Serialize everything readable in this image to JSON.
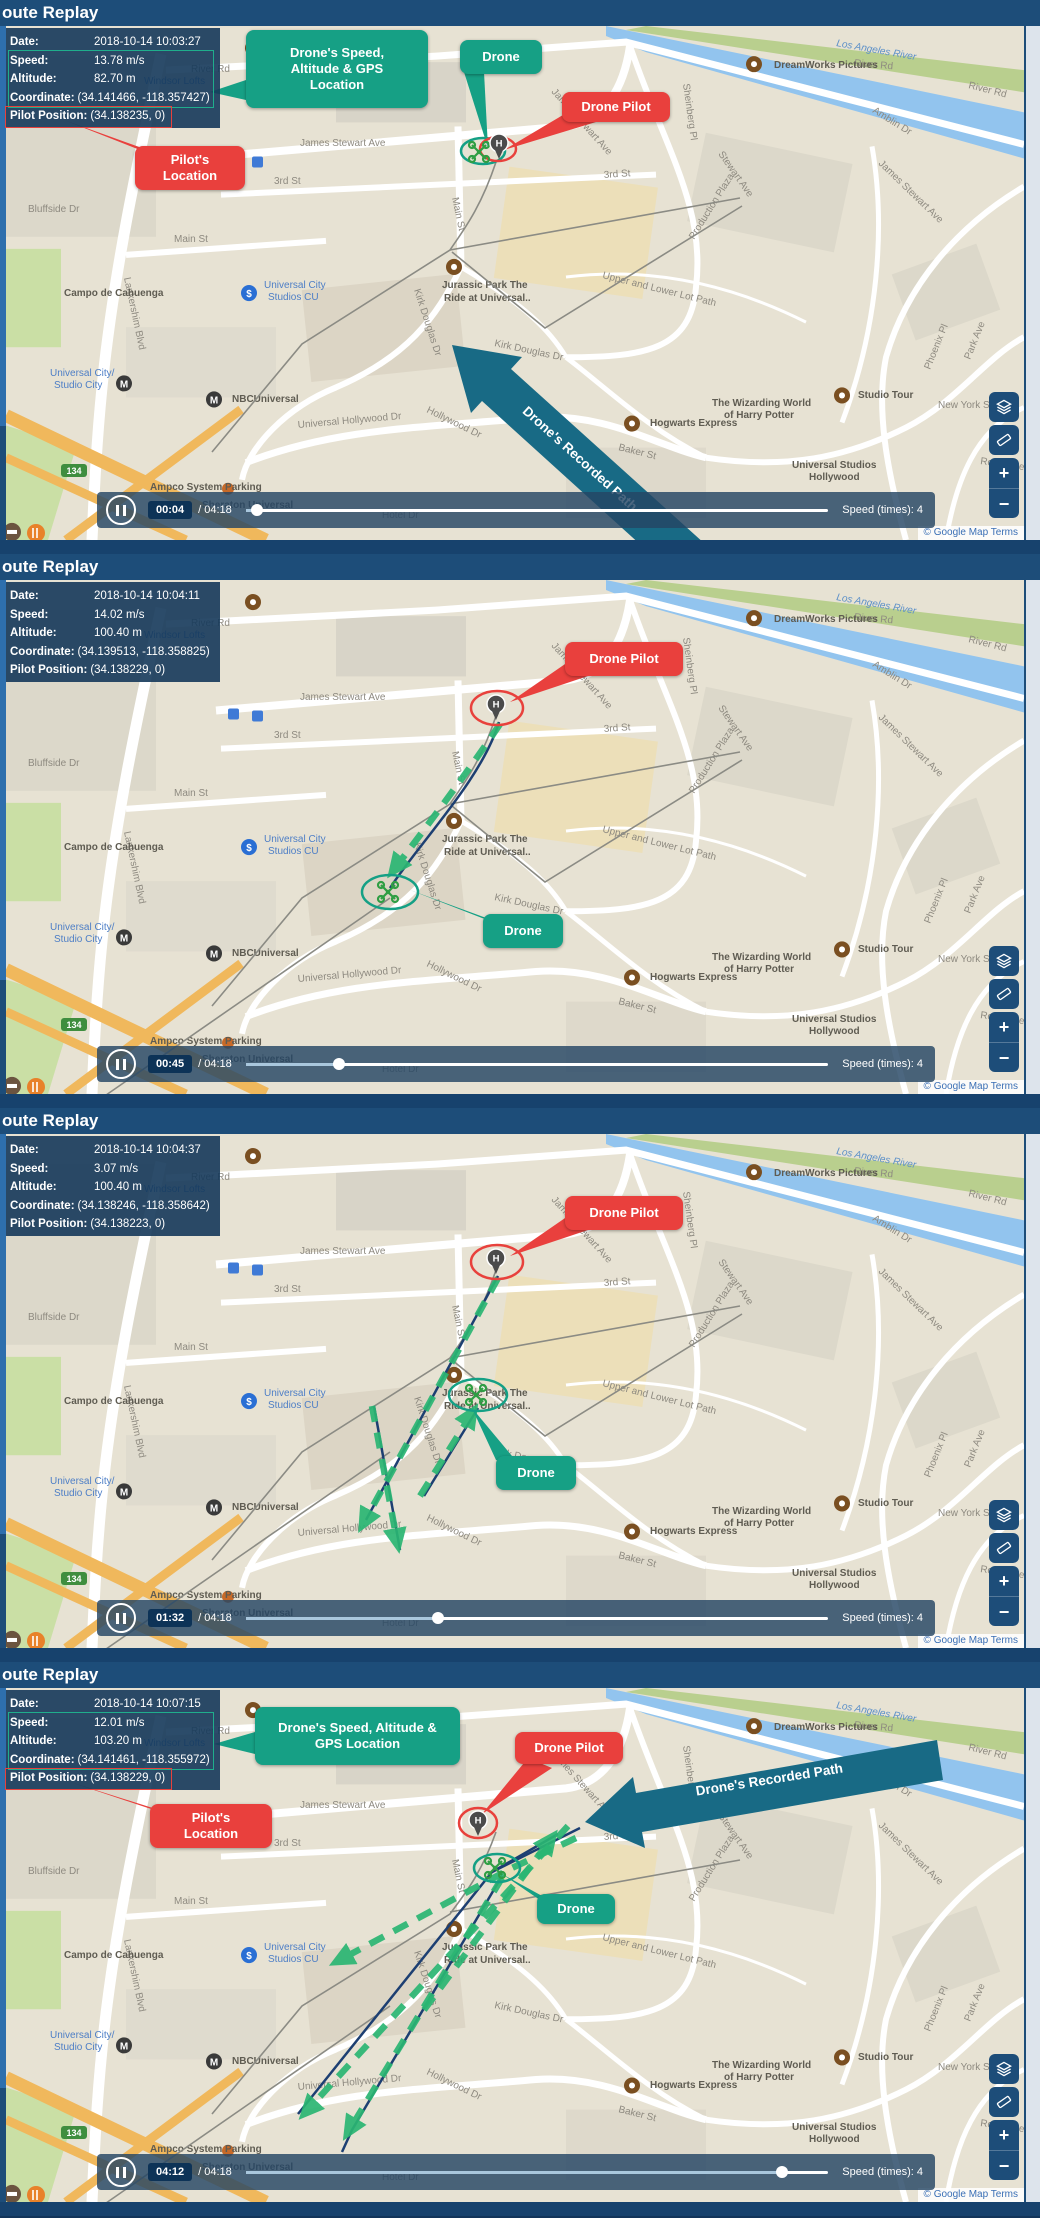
{
  "shared": {
    "header_title": "oute Replay",
    "attribution": "© Google Map Terms",
    "marker": {
      "pilot_letter": "H"
    },
    "info_labels": {
      "date": "Date:",
      "speed": "Speed:",
      "altitude": "Altitude:",
      "coordinate": "Coordinate:",
      "pilot_position": "Pilot Position:"
    },
    "callouts": {
      "drone": "Drone",
      "drone_pilot": "Drone Pilot",
      "speed_gps": "Drone's Speed, Altitude & GPS Location",
      "pilot_location": "Pilot's Location",
      "recorded_path": "Drone's Recorded Path"
    },
    "playback": {
      "duration_label": "/ 04:18",
      "duration": "04:18",
      "speed_label": "Speed (times): 4"
    },
    "zoom_in_glyph": "+",
    "zoom_out_glyph": "−"
  },
  "colors": {
    "header_navy": "#1d4d79",
    "info_overlay": "#15385a",
    "callout_green": "#16a085",
    "callout_red": "#e9403d",
    "recorded_path_arrow": "#186a85",
    "dashed_path_green": "#2bb673",
    "blue_path": "#1d3f72",
    "gray_path": "#8b8b84",
    "map_beige": "#e7e2d3",
    "water_blue": "#92c4ee",
    "freeway_orange": "#f0b85c",
    "played_track": "#a9c7dd"
  },
  "panels": [
    {
      "info": {
        "date": "2018-10-14 10:03:27",
        "speed": "13.78 m/s",
        "altitude": "82.70 m",
        "coordinate": "(34.141466, -118.357427)",
        "pilot_position": "(34.138235, 0)"
      },
      "playback": {
        "elapsed": "00:04",
        "progress_pct": 2
      }
    },
    {
      "info": {
        "date": "2018-10-14 10:04:11",
        "speed": "14.02 m/s",
        "altitude": "100.40 m",
        "coordinate": "(34.139513, -118.358825)",
        "pilot_position": "(34.138229, 0)"
      },
      "playback": {
        "elapsed": "00:45",
        "progress_pct": 16
      }
    },
    {
      "info": {
        "date": "2018-10-14 10:04:37",
        "speed": "3.07 m/s",
        "altitude": "100.40 m",
        "coordinate": "(34.138246, -118.358642)",
        "pilot_position": "(34.138223, 0)"
      },
      "playback": {
        "elapsed": "01:32",
        "progress_pct": 33
      }
    },
    {
      "info": {
        "date": "2018-10-14 10:07:15",
        "speed": "12.01 m/s",
        "altitude": "103.20 m",
        "coordinate": "(34.141461, -118.355972)",
        "pilot_position": "(34.138229, 0)"
      },
      "playback": {
        "elapsed": "04:12",
        "progress_pct": 92
      }
    }
  ],
  "map": {
    "labels": [
      {
        "t": "River Rd",
        "x": 185,
        "y": 46
      },
      {
        "t": "Los Angeles River",
        "x": 830,
        "y": 20,
        "r": 10,
        "cls": "water"
      },
      {
        "t": "River Rd",
        "x": 848,
        "y": 40,
        "r": 5
      },
      {
        "t": "River Rd",
        "x": 962,
        "y": 62,
        "r": 14
      },
      {
        "t": "DreamWorks Pictures",
        "x": 768,
        "y": 42,
        "cls": "poi"
      },
      {
        "t": "Amblin Dr",
        "x": 866,
        "y": 86,
        "r": 32
      },
      {
        "t": "Sheinberg Pl",
        "x": 677,
        "y": 58,
        "r": 82
      },
      {
        "t": "James Stewart Ave",
        "x": 294,
        "y": 120
      },
      {
        "t": "James Stewart Ave",
        "x": 545,
        "y": 66,
        "r": 48
      },
      {
        "t": "James Stewart Ave",
        "x": 872,
        "y": 138,
        "r": 44
      },
      {
        "t": "Stewart Ave",
        "x": 712,
        "y": 128,
        "r": 55
      },
      {
        "t": "Production Plaza",
        "x": 688,
        "y": 214,
        "r": -58,
        "s": 9
      },
      {
        "t": "3rd St",
        "x": 268,
        "y": 158
      },
      {
        "t": "3rd St",
        "x": 598,
        "y": 152,
        "r": -4
      },
      {
        "t": "Main St",
        "x": 168,
        "y": 216
      },
      {
        "t": "Main St",
        "x": 446,
        "y": 172,
        "r": 78
      },
      {
        "t": "Windsor Lofts",
        "x": 138,
        "y": 58,
        "cls": "blue"
      },
      {
        "t": "Bluffside Dr",
        "x": 22,
        "y": 186
      },
      {
        "t": "Lankershim Blvd",
        "x": 118,
        "y": 252,
        "r": 78
      },
      {
        "t": "Campo de Cahuenga",
        "x": 58,
        "y": 270,
        "cls": "poi",
        "s": 9
      },
      {
        "t": "Universal City",
        "x": 258,
        "y": 262,
        "cls": "blue"
      },
      {
        "t": "Studios CU",
        "x": 262,
        "y": 274,
        "cls": "blue"
      },
      {
        "t": "Universal City/",
        "x": 44,
        "y": 350,
        "cls": "blue"
      },
      {
        "t": "Studio City",
        "x": 48,
        "y": 362,
        "cls": "blue"
      },
      {
        "t": "NBCUniversal",
        "x": 226,
        "y": 376,
        "cls": "poi"
      },
      {
        "t": "Jurassic Park The",
        "x": 436,
        "y": 262,
        "cls": "poi"
      },
      {
        "t": "Ride at Universal..",
        "x": 438,
        "y": 275,
        "cls": "poi"
      },
      {
        "t": "Kirk Douglas Dr",
        "x": 488,
        "y": 320,
        "r": 12
      },
      {
        "t": "Kirk Douglas Dr",
        "x": 408,
        "y": 264,
        "r": 72
      },
      {
        "t": "Upper and Lower Lot Path",
        "x": 596,
        "y": 252,
        "r": 14,
        "s": 9
      },
      {
        "t": "Universal Hollywood Dr",
        "x": 292,
        "y": 402,
        "r": -5
      },
      {
        "t": "Hollywood Dr",
        "x": 420,
        "y": 386,
        "r": 26
      },
      {
        "t": "The Wizarding World",
        "x": 706,
        "y": 380,
        "cls": "poi"
      },
      {
        "t": "of Harry Potter",
        "x": 718,
        "y": 392,
        "cls": "poi"
      },
      {
        "t": "Hogwarts Express",
        "x": 644,
        "y": 400,
        "cls": "poi"
      },
      {
        "t": "Studio Tour",
        "x": 852,
        "y": 372,
        "cls": "poi"
      },
      {
        "t": "Universal Studios",
        "x": 786,
        "y": 442,
        "cls": "poi"
      },
      {
        "t": "Hollywood",
        "x": 803,
        "y": 454,
        "cls": "poi"
      },
      {
        "t": "Baker St",
        "x": 612,
        "y": 424,
        "r": 14
      },
      {
        "t": "Phoenix Pl",
        "x": 924,
        "y": 344,
        "r": -68
      },
      {
        "t": "Park Ave",
        "x": 964,
        "y": 334,
        "r": -68
      },
      {
        "t": "New York St",
        "x": 932,
        "y": 382
      },
      {
        "t": "Royal Cre",
        "x": 974,
        "y": 438,
        "r": 8
      },
      {
        "t": "Sheraton Universal",
        "x": 196,
        "y": 482,
        "cls": "poi"
      },
      {
        "t": "Ampco System Parking",
        "x": 144,
        "y": 464,
        "cls": "poi",
        "s": 9
      },
      {
        "t": "Hotel Dr",
        "x": 376,
        "y": 492
      },
      {
        "t": "134",
        "x": 68,
        "y": 448,
        "shield": true
      }
    ]
  }
}
